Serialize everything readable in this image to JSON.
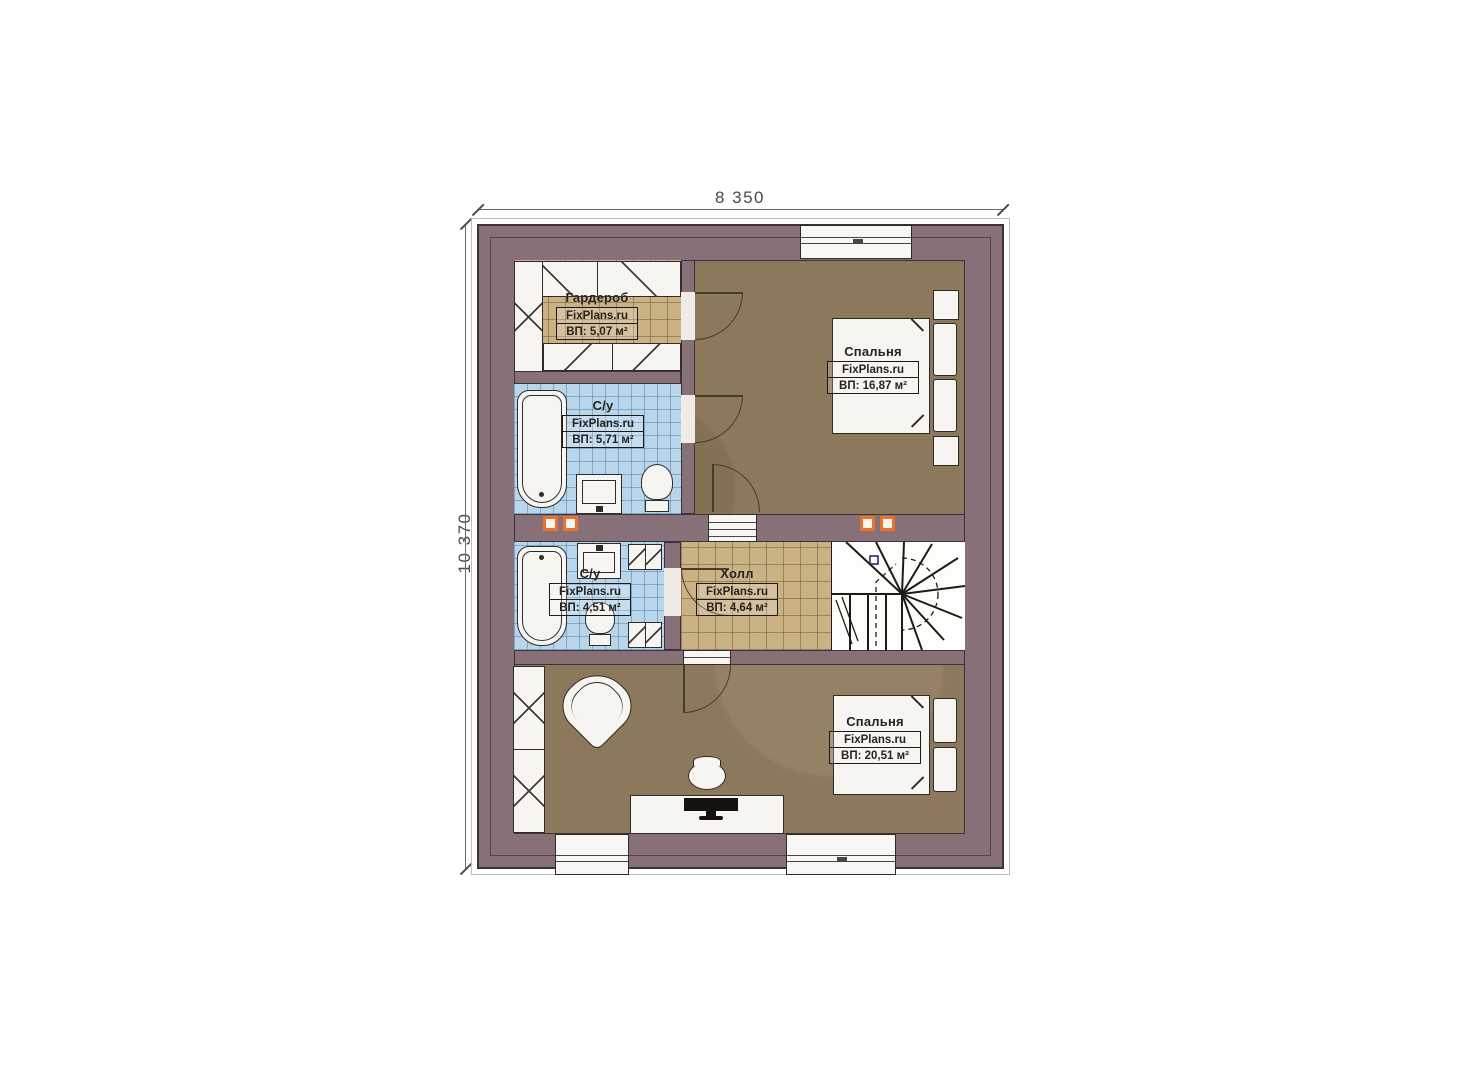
{
  "dimensions": {
    "width_label": "8 350",
    "height_label": "10 370"
  },
  "branding": {
    "watermark": "FixPlans.ru"
  },
  "rooms": [
    {
      "id": "wardrobe",
      "name": "Гардероб",
      "watermark": "FixPlans.ru",
      "area": "ВП: 5,07 м²"
    },
    {
      "id": "bathroom-top",
      "name": "С/у",
      "watermark": "FixPlans.ru",
      "area": "ВП: 5,71 м²"
    },
    {
      "id": "bedroom-top",
      "name": "Спальня",
      "watermark": "FixPlans.ru",
      "area": "ВП: 16,87 м²"
    },
    {
      "id": "bathroom-middle",
      "name": "С/у",
      "watermark": "FixPlans.ru",
      "area": "ВП: 4,51 м²"
    },
    {
      "id": "hall",
      "name": "Холл",
      "watermark": "FixPlans.ru",
      "area": "ВП: 4,64 м²"
    },
    {
      "id": "bedroom-bottom",
      "name": "Спальня",
      "watermark": "FixPlans.ru",
      "area": "ВП: 20,51 м²"
    }
  ],
  "colors": {
    "wall": "#877078",
    "outline": "#3c3238",
    "floor_wood": "#8c795b",
    "floor_tile_tan": "#cbb285",
    "floor_tile_blue": "#b7d6ec",
    "fixture": "#f6f5f2",
    "vent_accent": "#e8732e"
  }
}
